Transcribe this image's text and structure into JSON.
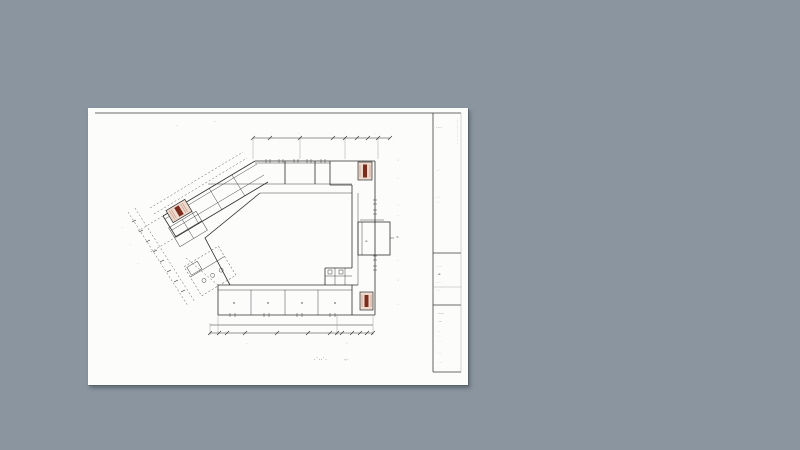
{
  "window": {
    "name": "cad-drawing-viewer"
  },
  "colors": {
    "canvas_bg": "#8a95a0",
    "sheet_bg": "#fcfcfb",
    "line": "#2f2f2f",
    "line_light": "#8a8a8a",
    "dash": "#5a5a5a",
    "stair_fill": "#eddacd",
    "stair_accent": "#7c2c1c"
  },
  "caption": {
    "main": "·˙··˙·",
    "scale": "·:··"
  },
  "entrance": {
    "label": "≡·"
  },
  "title_block": {
    "vertical_text": "· ···· ····· ··· ···· ·· ··",
    "row1": "· ···",
    "row2": "···˙",
    "row3a": "·· ·˙",
    "row3b": "˙ ··",
    "sec2": [
      "··  ···",
      "·  ≡·",
      "··  ··",
      "·  ··"
    ],
    "sec3": [
      "——",
      "·—",
      "··",
      "· ·",
      "˙··",
      "· ··"
    ]
  },
  "dims": {
    "top": [
      "·",
      "˙",
      "··",
      "·",
      "˙",
      "·",
      "··"
    ],
    "right": [
      "·˒",
      "··",
      "˙·",
      "··",
      "±·",
      "··",
      "·˒",
      "··"
    ],
    "left": [
      "··",
      "˙·",
      "··"
    ],
    "bottom": [
      "··",
      "·˒"
    ],
    "topleft": [
      "‥",
      "‥"
    ]
  }
}
